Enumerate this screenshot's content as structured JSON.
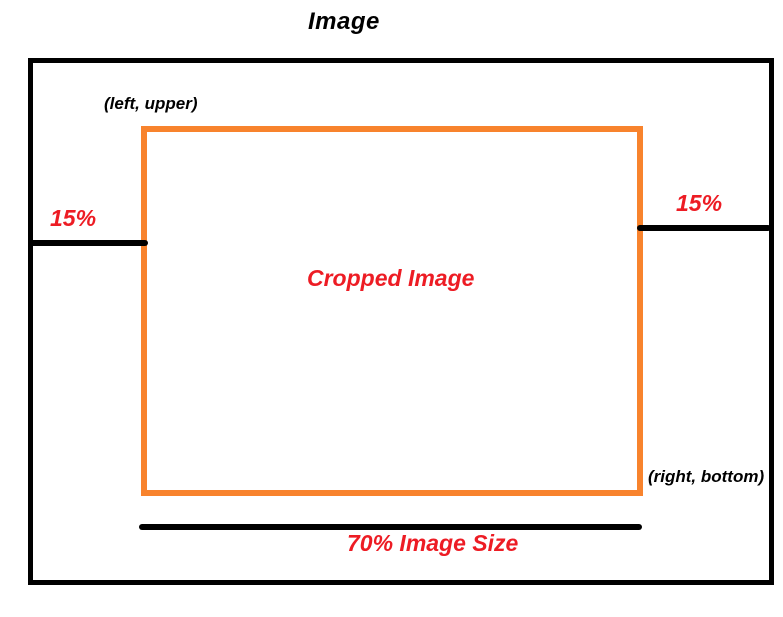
{
  "title": "Image",
  "crop_diagram": {
    "corner_label_top_left": "(left, upper)",
    "corner_label_bottom_right": "(right, bottom)",
    "crop_label": "Cropped Image",
    "left_margin_label": "15%",
    "right_margin_label": "15%",
    "bottom_size_label": "70% Image Size"
  },
  "colors": {
    "image_outline": "#000000",
    "crop_border": "#F8832D",
    "annotation_red": "#ED1C24",
    "background": "#FFFFFF"
  }
}
